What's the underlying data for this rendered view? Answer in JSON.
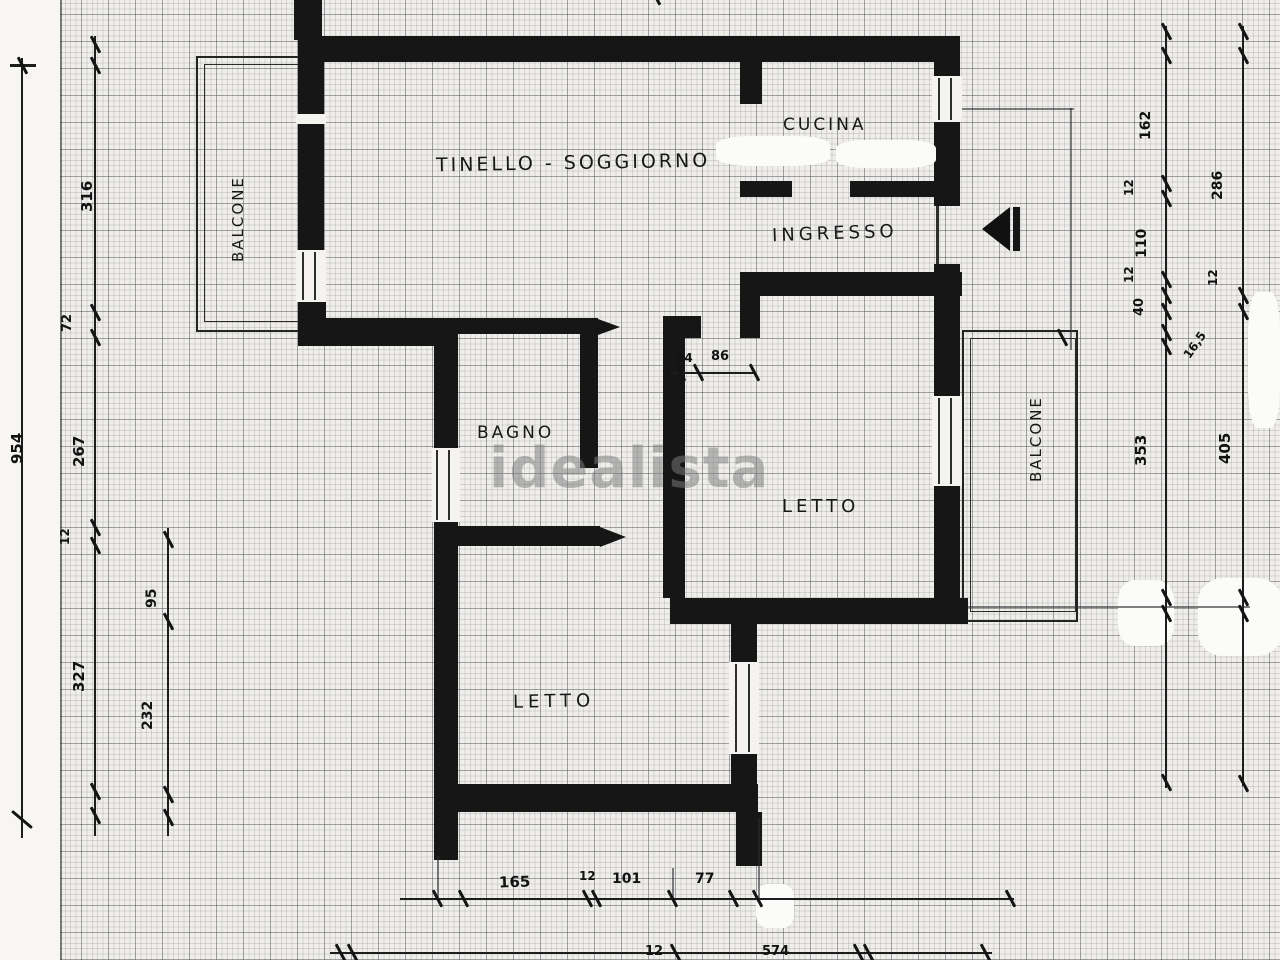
{
  "watermark": {
    "text": "idealista"
  },
  "rooms": {
    "tinello": "TINELLO - SOGGIORNO",
    "cucina": "CUCINA",
    "ingresso": "INGRESSO",
    "bagno": "BAGNO",
    "letto_right": "LETTO",
    "letto_bottom": "LETTO",
    "balcone_left": "BALCONE",
    "balcone_right": "BALCONE"
  },
  "dims": {
    "total_left": "954",
    "left1": [
      "316",
      "72",
      "267",
      "12",
      "327"
    ],
    "left2": [
      "95",
      "232"
    ],
    "right1": [
      "162",
      "12",
      "110",
      "12",
      "40",
      "16,5",
      "353"
    ],
    "right2": [
      "286",
      "12",
      "405"
    ],
    "door": [
      "24",
      "86"
    ],
    "bottom": [
      "165",
      "12",
      "101",
      "77"
    ],
    "bottom_edge": [
      "12",
      "574"
    ]
  },
  "colors": {
    "wall": "#161616",
    "paper": "#efeeea",
    "grid_minor": "#b9b9bd",
    "grid_major": "#70707a",
    "watermark": "#7d7d7d"
  }
}
